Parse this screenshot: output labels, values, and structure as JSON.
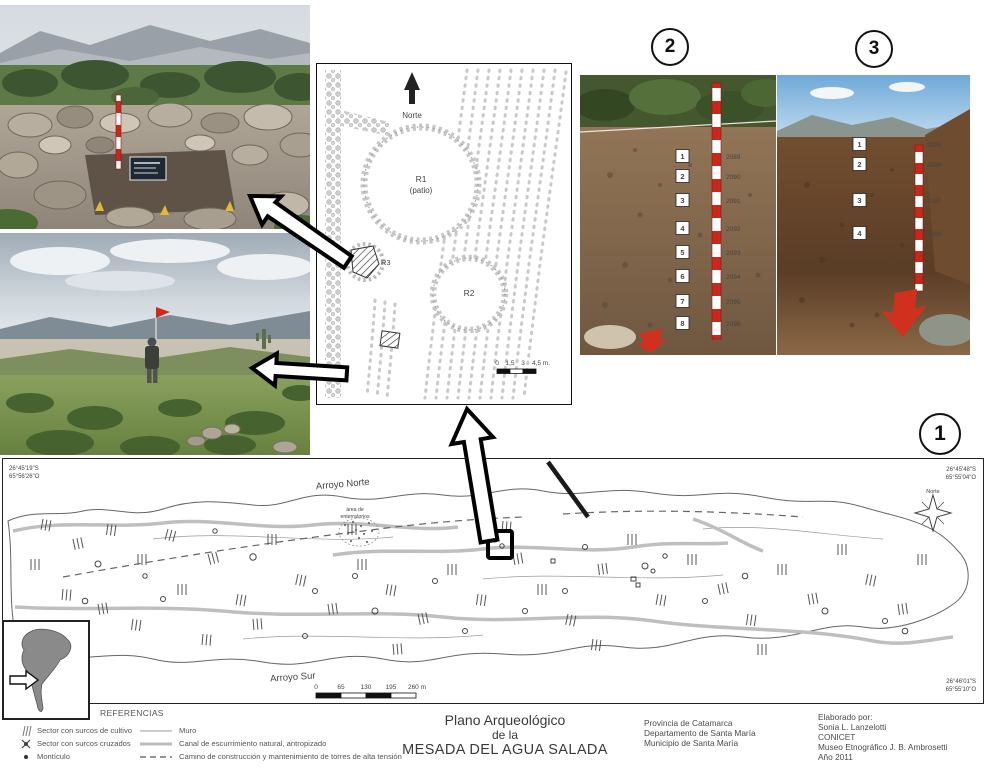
{
  "panels": {
    "map_label": "1",
    "profile2_label": "2",
    "profile3_label": "3"
  },
  "plan": {
    "north": "Norte",
    "r1": "R1",
    "r1_sub": "(patio)",
    "r2": "R2",
    "r3": "R3",
    "scale": [
      "0",
      "1,5",
      "3",
      "4,5 m."
    ]
  },
  "profile2": {
    "tags": [
      {
        "n": "1",
        "code": "2089"
      },
      {
        "n": "2",
        "code": "2090"
      },
      {
        "n": "3",
        "code": "2091"
      },
      {
        "n": "4",
        "code": "2092"
      },
      {
        "n": "5",
        "code": "2093"
      },
      {
        "n": "6",
        "code": "2094"
      },
      {
        "n": "7",
        "code": "2095"
      },
      {
        "n": "8",
        "code": "2096"
      }
    ]
  },
  "profile3": {
    "tags": [
      {
        "n": "1",
        "code": "2085"
      },
      {
        "n": "2",
        "code": "2086"
      },
      {
        "n": "3",
        "code": "2087"
      },
      {
        "n": "4",
        "code": "2088"
      }
    ]
  },
  "map": {
    "coord_tl1": "26°45'19\"S",
    "coord_tl2": "65°56'26\"O",
    "coord_tr1": "26°45'48\"S",
    "coord_tr2": "65°55'04\"O",
    "coord_br1": "26°46'01\"S",
    "coord_br2": "65°55'10\"O",
    "north": "Norte",
    "arroyo_norte": "Arroyo Norte",
    "arroyo_sur": "Arroyo Sur",
    "area1": "área de",
    "area2": "enterratorios",
    "scale": [
      "0",
      "65",
      "130",
      "195",
      "260 m"
    ]
  },
  "legend": {
    "title": "REFERENCIAS",
    "left": [
      "Sector con surcos de cultivo",
      "Sector con surcos cruzados",
      "Montículo"
    ],
    "right": [
      "Muro",
      "Canal de escurrimiento natural, antropizado",
      "Camino de construcción y mantenimiento de torres de alta tensión"
    ]
  },
  "title_block": {
    "l1": "Plano Arqueológico",
    "l2": "de la",
    "l3": "MESADA DEL AGUA SALADA"
  },
  "location_block": {
    "l1": "Provincia de Catamarca",
    "l2": "Departamento de Santa María",
    "l3": "Municipio de Santa María"
  },
  "credits_block": {
    "l1": "Elaborado por:",
    "l2": "Sonia L. Lanzelotti",
    "l3": "CONICET",
    "l4": "Museo Etnográfico J. B. Ambrosetti",
    "l5": "Año 2011"
  },
  "colors": {
    "rod_red": "#c8271c",
    "canal_gray": "#bfbfbf",
    "ink": "#111111"
  }
}
